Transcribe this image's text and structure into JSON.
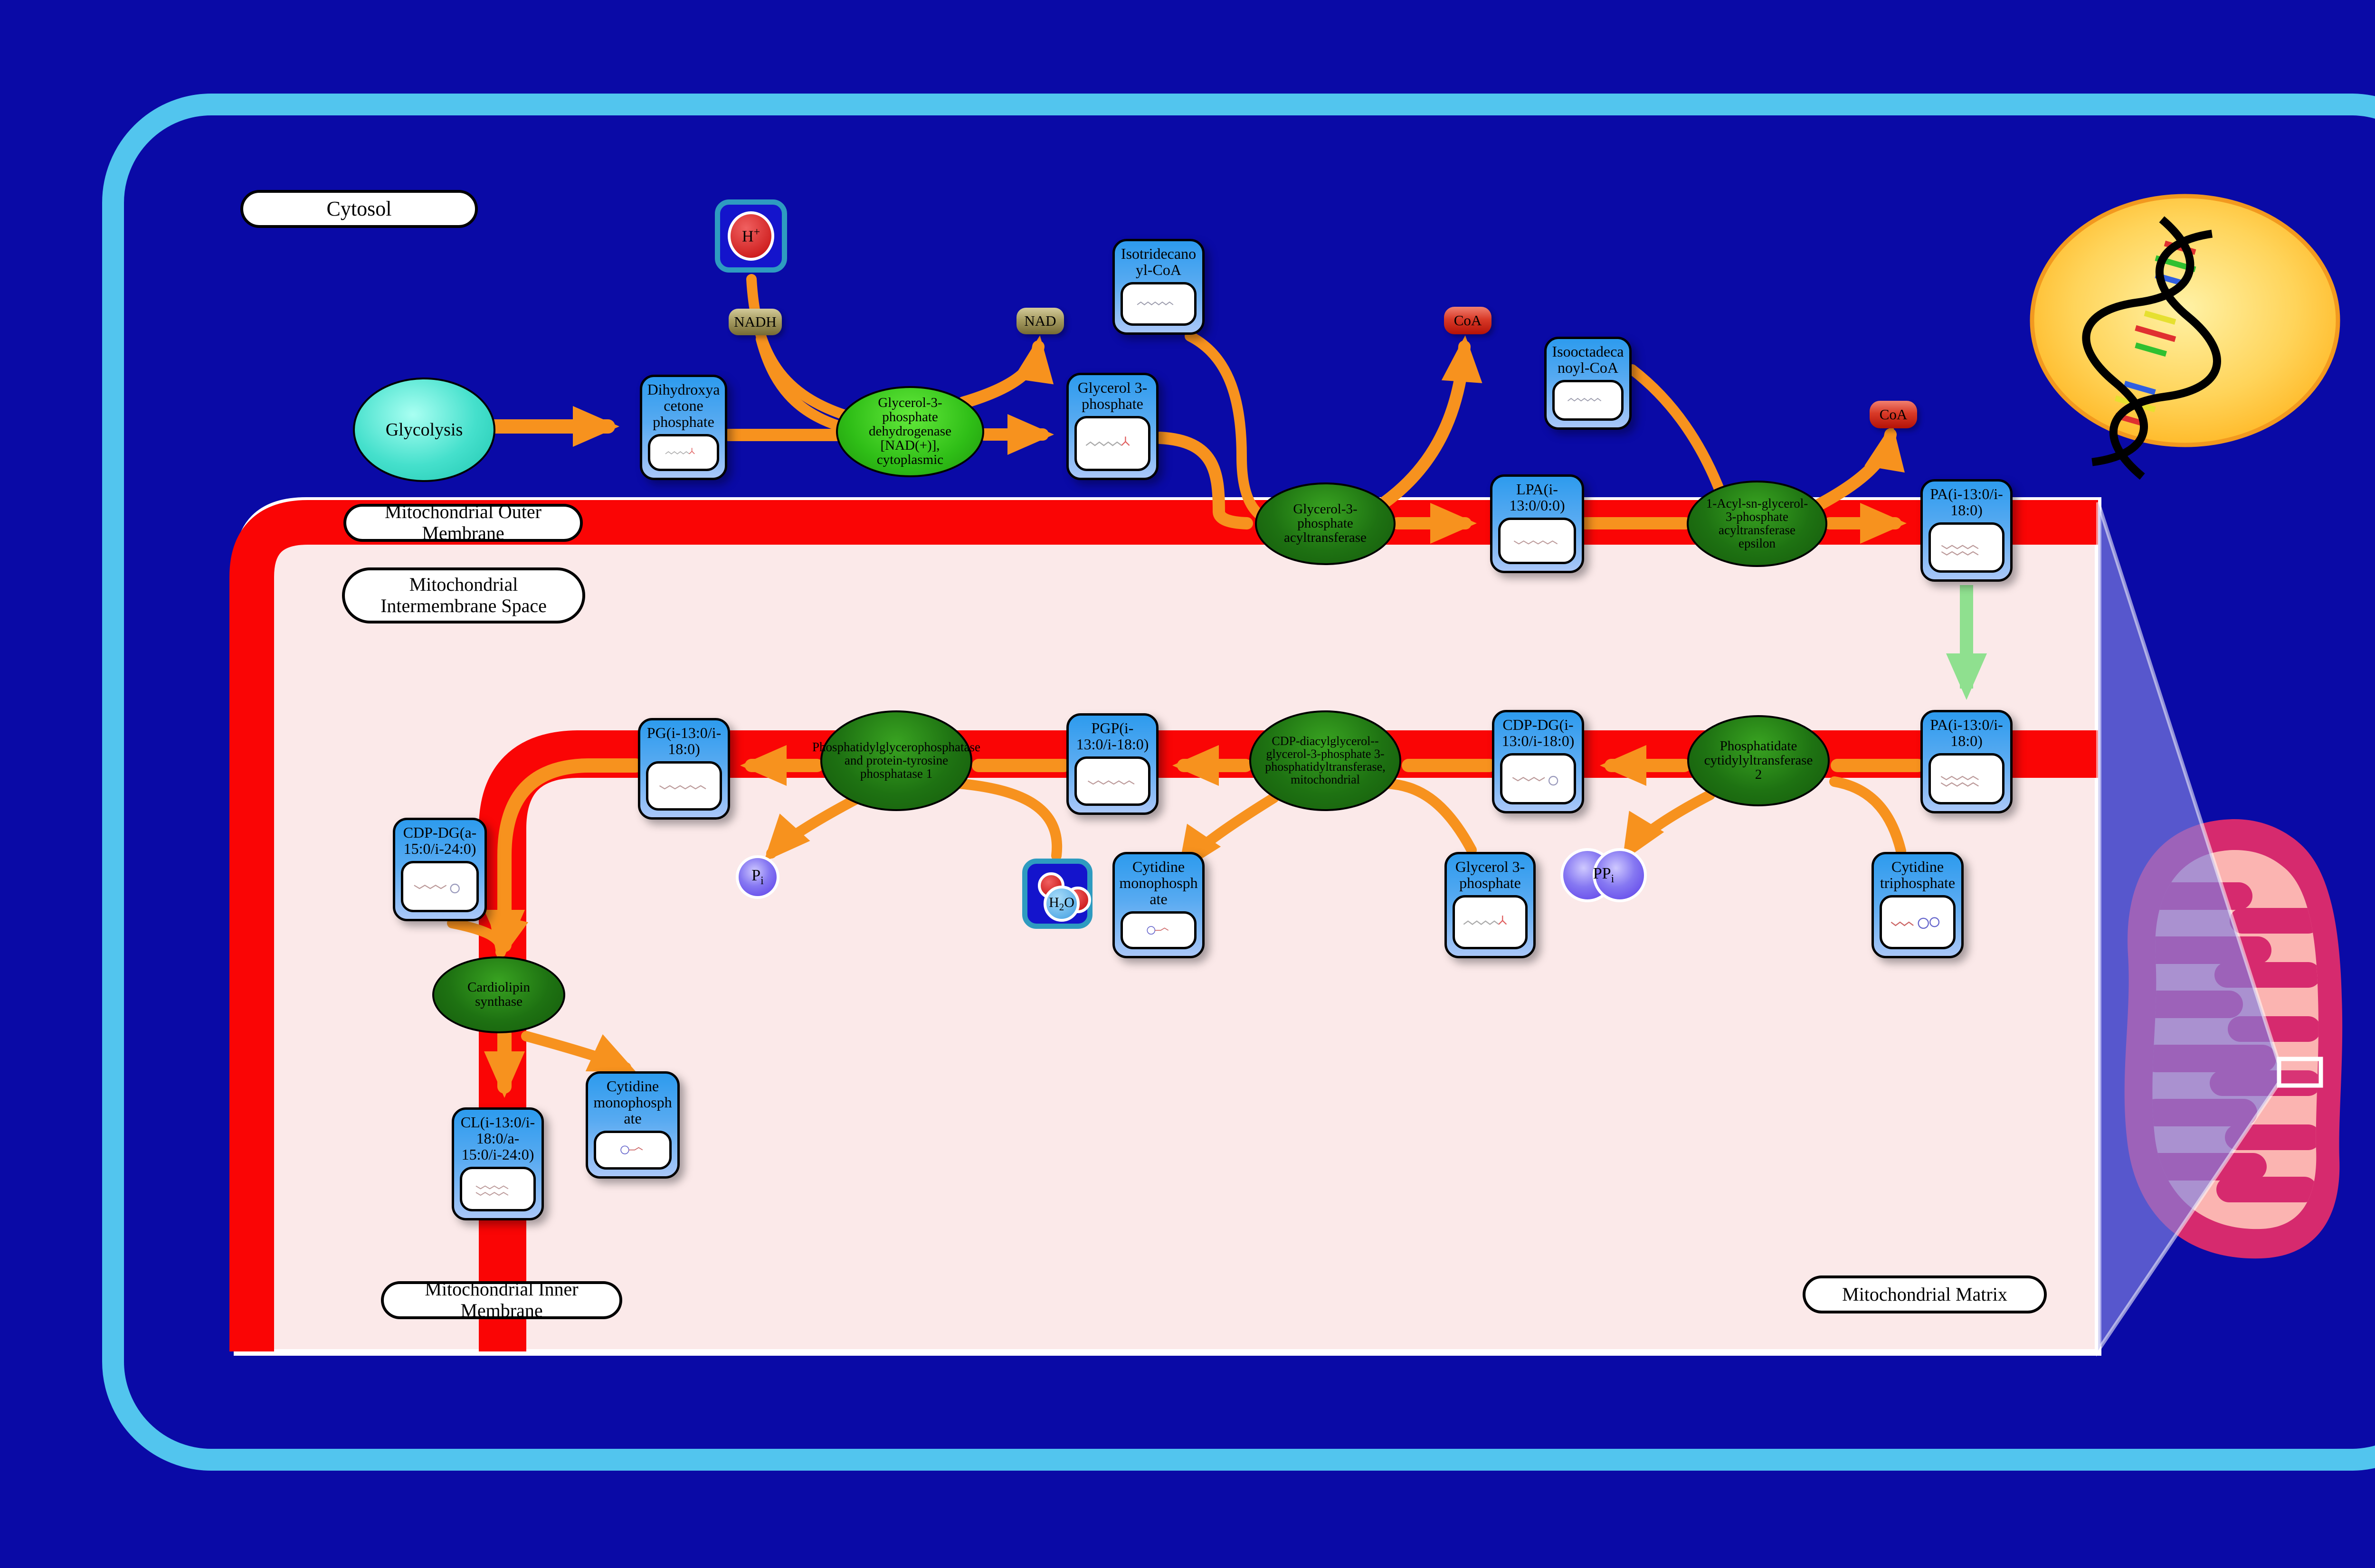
{
  "regions": {
    "cytosol": "Cytosol",
    "outer_membrane": "Mitochondrial Outer Membrane",
    "intermembrane_space": "Mitochondrial Intermembrane Space",
    "inner_membrane": "Mitochondrial Inner Membrane",
    "matrix": "Mitochondrial Matrix"
  },
  "source": {
    "glycolysis": "Glycolysis"
  },
  "metabolites": {
    "dhap": "Dihydroxyacetone phosphate",
    "g3p_cytosol": "Glycerol 3-phosphate",
    "isotridecanoyl_coa": "Isotridecanoyl-CoA",
    "isooctadecanoyl_coa": "Isooctadecanoyl-CoA",
    "lpa": "LPA(i-13:0/0:0)",
    "pa_outer": "PA(i-13:0/i-18:0)",
    "pa_inner": "PA(i-13:0/i-18:0)",
    "cdp_dg_1": "CDP-DG(i-13:0/i-18:0)",
    "pgp": "PGP(i-13:0/i-18:0)",
    "pg": "PG(i-13:0/i-18:0)",
    "cdp_dg_2": "CDP-DG(a-15:0/i-24:0)",
    "cl": "CL(i-13:0/i-18:0/a-15:0/i-24:0)",
    "ctp": "Cytidine triphosphate",
    "g3p_matrix": "Glycerol 3-phosphate",
    "cmp_matrix": "Cytidine monophosphate",
    "cmp_inner": "Cytidine monophosphate"
  },
  "enzymes": {
    "gpd": "Glycerol-3-phosphate dehydrogenase [NAD(+)], cytoplasmic",
    "gpat": "Glycerol-3-phosphate acyltransferase",
    "agpat_epsilon": "1-Acyl-sn-glycerol-3-phosphate acyltransferase epsilon",
    "pcyt2": "Phosphatidate cytidylyltransferase 2",
    "pgs1": "CDP-diacylglycerol--glycerol-3-phosphate 3-phosphatidyltransferase, mitochondrial",
    "ptpmt1": "Phosphatidylglycerophosphatase and protein-tyrosine phosphatase 1",
    "crls1": "Cardiolipin synthase"
  },
  "cofactors": {
    "nadh": "NADH",
    "nad": "NAD",
    "coa_top": "CoA",
    "coa_right": "CoA",
    "h_plus": {
      "base": "H",
      "sup": "+"
    },
    "h2o": {
      "base": "H",
      "sub": "2",
      "rest": "O"
    },
    "pi": {
      "base": "P",
      "sub": "i"
    },
    "ppi": {
      "base": "PP",
      "sub": "i"
    }
  },
  "colors": {
    "background": "#0A0AA6",
    "cell_border": "#52C5EE",
    "membrane_red": "#FA0505",
    "panel_pink": "#FBE9E9",
    "arrow_orange": "#F7921E",
    "transport_green": "#8FE08F",
    "node_blue": "#2D9BEE",
    "enzyme_green": "#1E7212",
    "nucleus_yellow": "#FFC125",
    "mitochondrion_crimson": "#D62A6E"
  }
}
